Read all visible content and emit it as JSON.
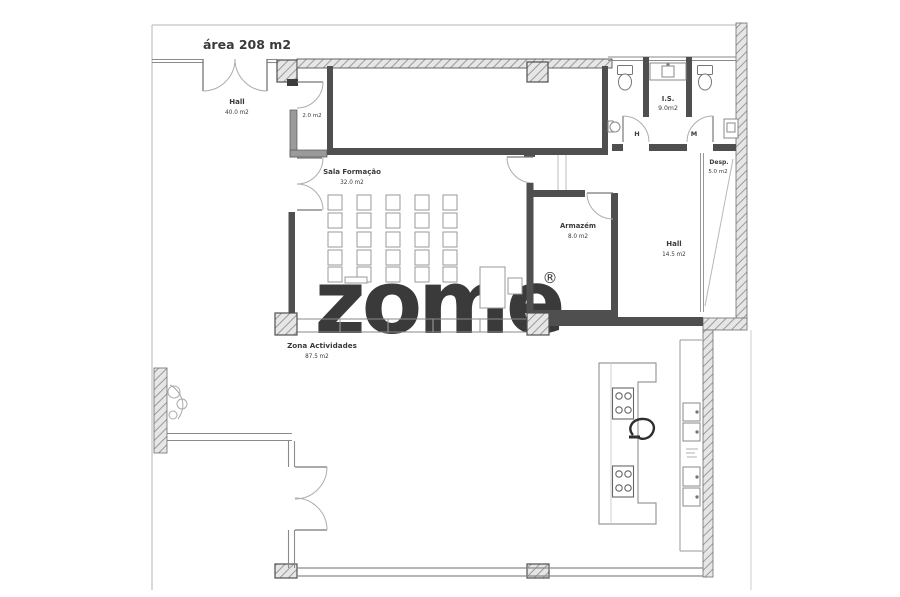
{
  "title": "área 208 m2",
  "watermark": {
    "text": "zome",
    "mark": "®"
  },
  "rooms": {
    "hall_main": {
      "name": "Hall",
      "area": "40.0 m2"
    },
    "vestibule": {
      "area": "2.0 m2"
    },
    "sala_formacao": {
      "name": "Sala Formação",
      "area": "32.0 m2"
    },
    "is": {
      "name": "I.S.",
      "area": "9.0m2"
    },
    "wc_h": {
      "name": "H"
    },
    "wc_m": {
      "name": "M"
    },
    "desp": {
      "name": "Desp.",
      "area": "5.0 m2"
    },
    "armazem": {
      "name": "Armazém",
      "area": "8.0 m2"
    },
    "hall_right": {
      "name": "Hall",
      "area": "14.5 m2"
    },
    "zona_actividades": {
      "name": "Zona Actividades",
      "area": "87.5 m2"
    }
  },
  "colors": {
    "wall_dark": "#4f4f4f",
    "line": "#8a8a8a",
    "faint": "#bdbdbd",
    "hatch": "#9a9a9a"
  }
}
